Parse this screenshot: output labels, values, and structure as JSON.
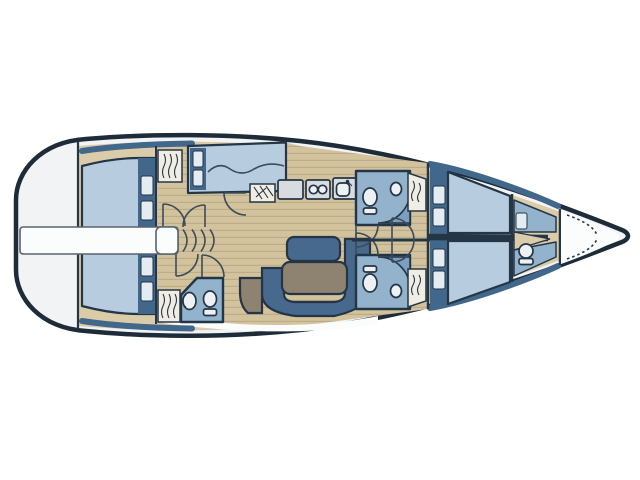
{
  "plan": {
    "title": "Sailing yacht interior deck plan, bow to the right",
    "orientation": {
      "bow": "right",
      "stern": "left",
      "port_side": "top",
      "starboard_side": "bottom"
    },
    "rooms": [
      {
        "name": "swim-platform-transom",
        "fixtures": []
      },
      {
        "name": "companionway",
        "fixtures": [
          "engine-box",
          "steps"
        ]
      },
      {
        "name": "aft-cabin-port",
        "fixtures": [
          "double-berth",
          "pillows",
          "hanging-locker",
          "door"
        ]
      },
      {
        "name": "aft-cabin-starboard",
        "fixtures": [
          "double-berth",
          "pillows",
          "hanging-locker",
          "door"
        ]
      },
      {
        "name": "aft-head-starboard",
        "fixtures": [
          "toilet",
          "washbasin",
          "door"
        ]
      },
      {
        "name": "navigation-berth-port",
        "fixtures": [
          "settee-berth",
          "pillows",
          "wavy-cushion-line"
        ]
      },
      {
        "name": "icebox-locker",
        "fixtures": [
          "hatched-lid"
        ]
      },
      {
        "name": "galley-port",
        "fixtures": [
          "worktop",
          "two-burner-stove",
          "sink-with-faucet"
        ]
      },
      {
        "name": "salon",
        "fixtures": [
          "u-shaped-settee",
          "table",
          "bench",
          "chair"
        ]
      },
      {
        "name": "mid-head-port",
        "fixtures": [
          "toilet",
          "washbasin",
          "shower",
          "door",
          "hanging-locker"
        ]
      },
      {
        "name": "mid-head-starboard",
        "fixtures": [
          "toilet",
          "washbasin",
          "shower",
          "door",
          "hanging-locker"
        ]
      },
      {
        "name": "forward-cabin",
        "fixtures": [
          "v-berths",
          "pillows",
          "doors"
        ]
      },
      {
        "name": "forepeak-crew-cabin",
        "fixtures": [
          "berth",
          "pillow",
          "toilet"
        ]
      },
      {
        "name": "anchor-locker",
        "fixtures": [
          "chain"
        ]
      }
    ]
  },
  "colors": {
    "hull_line": "#1e2c3a",
    "deck_white": "#f2f3f4",
    "side_deck": "#dacca9",
    "floor": "#d2c39d",
    "floor_stripe": "#bcac89",
    "berth_blue": "#b7cddf",
    "pillow_light": "#e4ebf1",
    "headboard_blue": "#41678b",
    "head_room_blue": "#93b2cc",
    "shower_blue": "#7b9fc0",
    "fixture_white": "#edf1f4",
    "settee_blue": "#47698d",
    "furniture_brown": "#8e8271",
    "counter_gray": "#d8dcdf",
    "locker_cream": "#f1ede2",
    "wall_navy": "#243646",
    "white_strip": "#fbfcfc"
  }
}
